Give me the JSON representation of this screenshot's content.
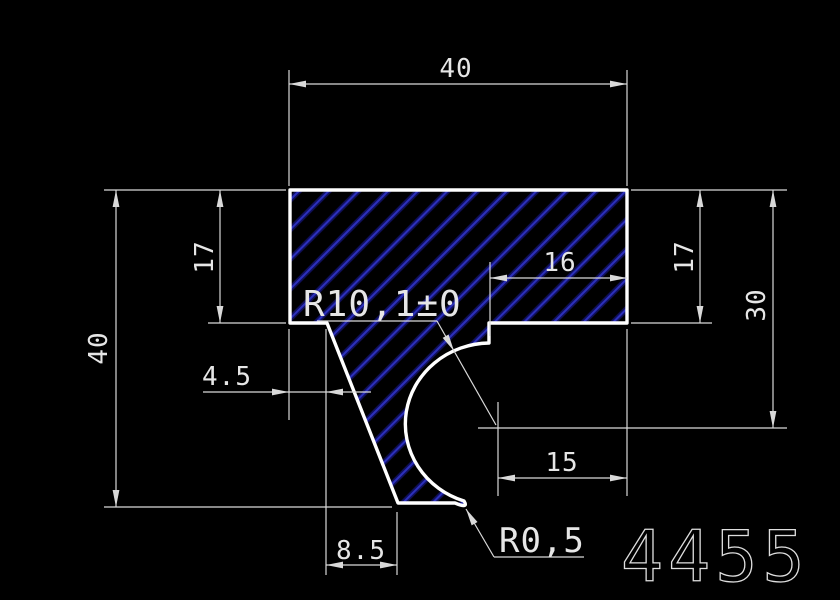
{
  "drawing": {
    "part_number": "4455",
    "dims": {
      "top_width": "40",
      "overall_height": "40",
      "left_flange_thickness": "17",
      "right_flange_thickness": "17",
      "notch_width": "16",
      "notch_depth": "30",
      "slant_top_offset": "4.5",
      "arc_center_to_edge": "15",
      "slant_run": "8.5",
      "large_radius": "R10,1±0",
      "small_radius": "R0,5"
    },
    "colors": {
      "background": "#000000",
      "outline": "#ffffff",
      "dimension": "#d9d9d9",
      "text": "#e6e6e6",
      "part_number": "#dedede",
      "hatch_glow": "#10105e",
      "hatch_line": "#2c30bc"
    }
  }
}
